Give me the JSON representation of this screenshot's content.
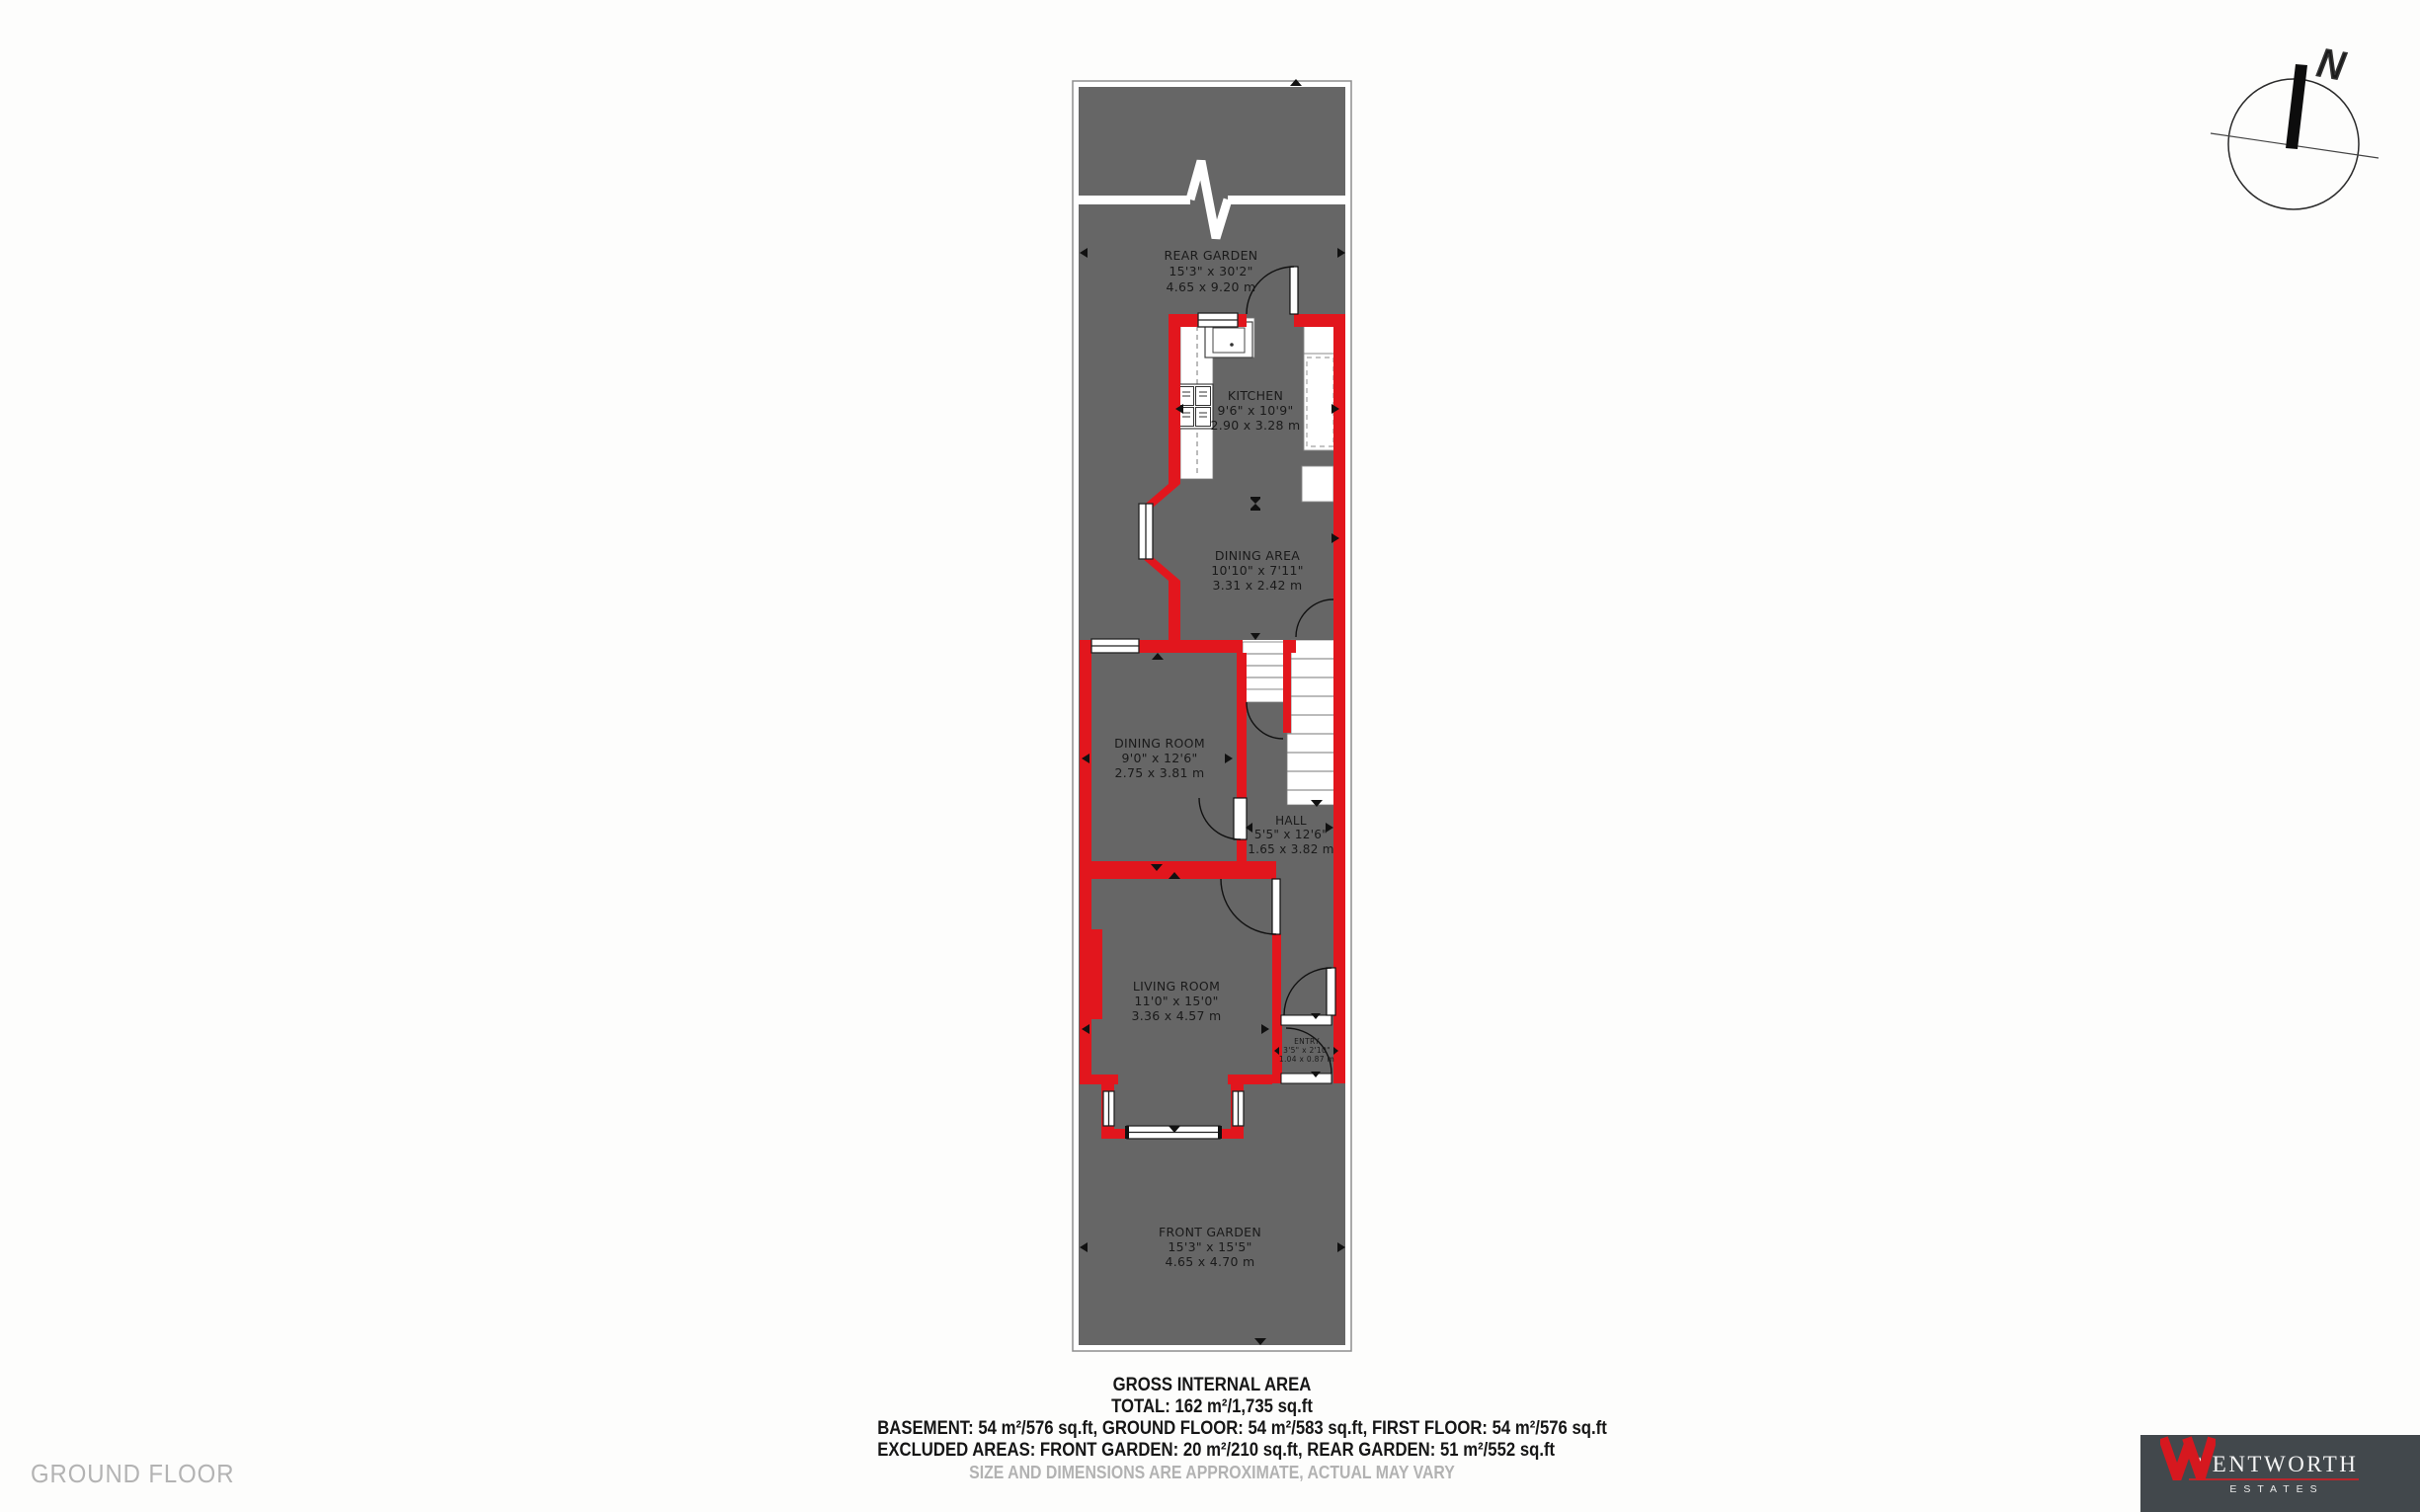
{
  "floor_title": "GROUND FLOOR",
  "compass": {
    "north_label": "N"
  },
  "rooms": {
    "rear_garden": {
      "name": "REAR GARDEN",
      "imperial": "15'3\" x 30'2\"",
      "metric": "4.65 x 9.20 m"
    },
    "kitchen": {
      "name": "KITCHEN",
      "imperial": "9'6\" x 10'9\"",
      "metric": "2.90 x 3.28 m"
    },
    "dining_area": {
      "name": "DINING AREA",
      "imperial": "10'10\" x 7'11\"",
      "metric": "3.31 x 2.42 m"
    },
    "dining_room": {
      "name": "DINING ROOM",
      "imperial": "9'0\" x 12'6\"",
      "metric": "2.75 x 3.81 m"
    },
    "hall": {
      "name": "HALL",
      "imperial": "5'5\" x 12'6\"",
      "metric": "1.65 x 3.82 m"
    },
    "living_room": {
      "name": "LIVING ROOM",
      "imperial": "11'0\" x 15'0\"",
      "metric": "3.36 x 4.57 m"
    },
    "entry": {
      "name": "ENTRY",
      "imperial": "3'5\" x 2'10\"",
      "metric": "1.04 x 0.87 m"
    },
    "front_garden": {
      "name": "FRONT GARDEN",
      "imperial": "15'3\" x 15'5\"",
      "metric": "4.65 x 4.70 m"
    }
  },
  "summary": {
    "title": "GROSS INTERNAL AREA",
    "total": "TOTAL: 162 m²/1,735 sq.ft",
    "floors": "BASEMENT: 54 m²/576 sq.ft, GROUND FLOOR: 54 m²/583 sq.ft, FIRST FLOOR: 54 m²/576 sq.ft",
    "excluded": "EXCLUDED AREAS: FRONT GARDEN: 20 m²/210 sq.ft, REAR GARDEN: 51 m²/552 sq.ft",
    "disclaimer": "SIZE AND DIMENSIONS ARE APPROXIMATE, ACTUAL MAY VARY"
  },
  "brand": {
    "name": "WENTWORTH",
    "sub": "ESTATES"
  },
  "colors": {
    "wall_red": "#e2161d",
    "floor_gray": "#666666",
    "brand_bg": "#42484c",
    "brand_red": "#d6181f"
  }
}
